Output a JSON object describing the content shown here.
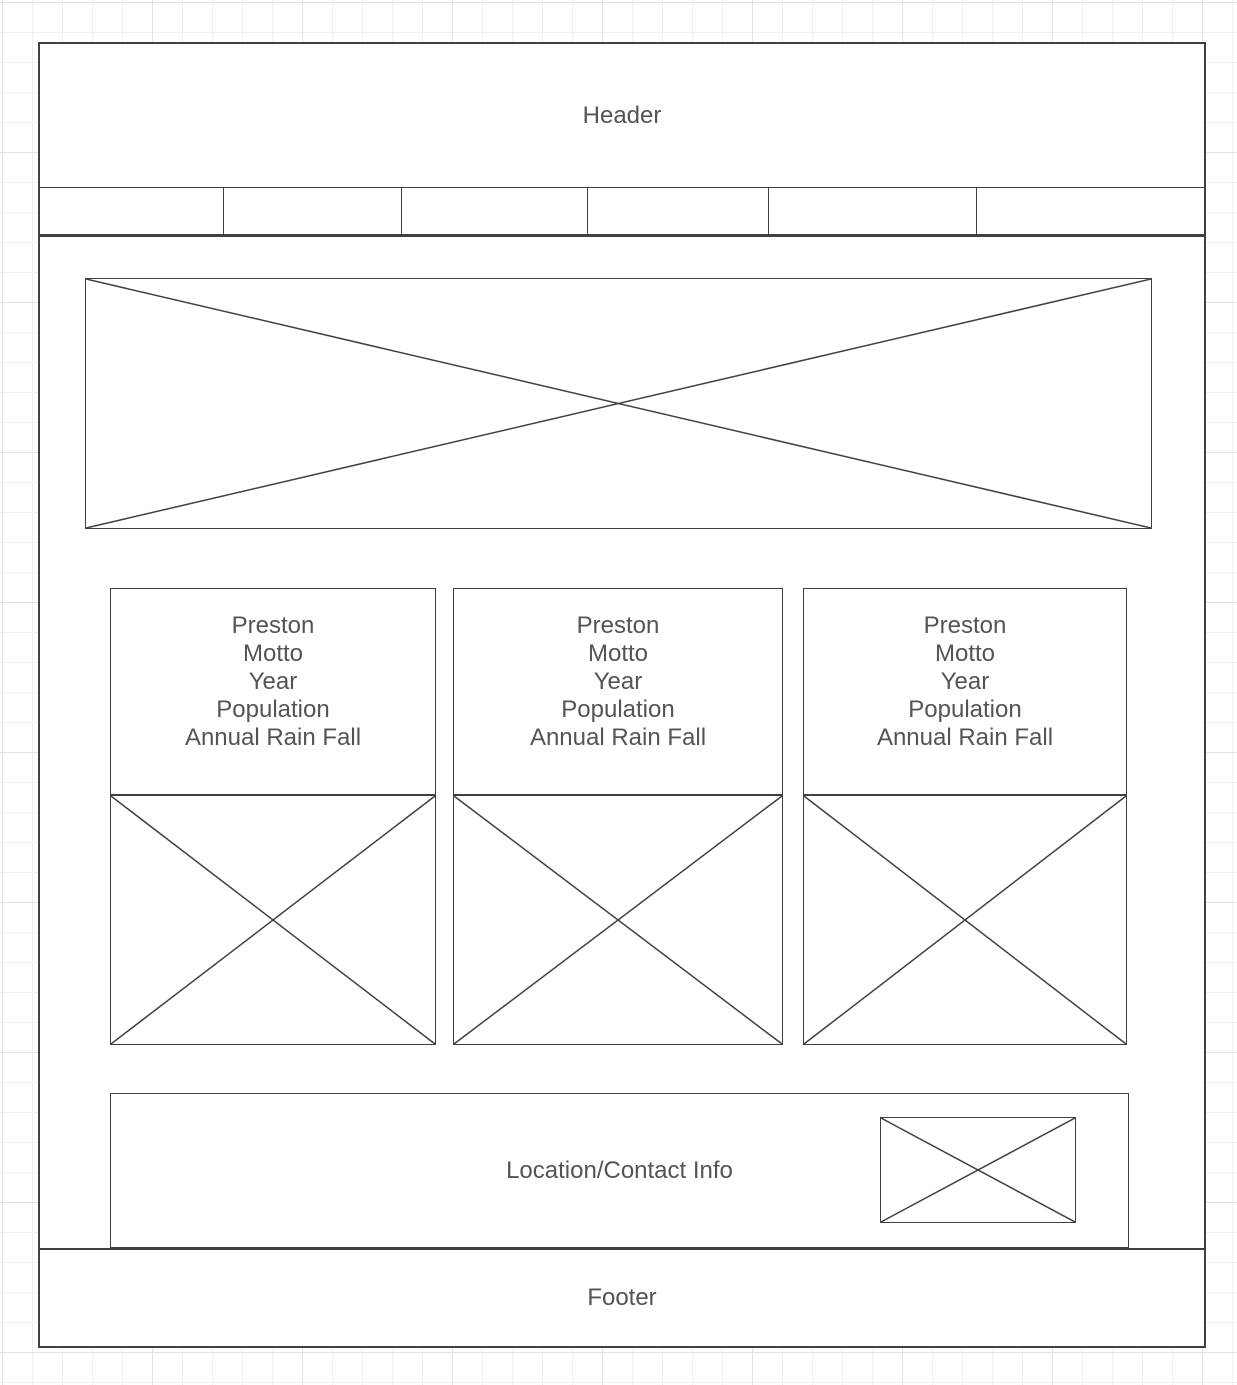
{
  "header": {
    "label": "Header"
  },
  "nav": {
    "cells": [
      "",
      "",
      "",
      "",
      "",
      ""
    ]
  },
  "cards": [
    {
      "lines": [
        "Preston",
        "Motto",
        "Year",
        "Population",
        "Annual Rain Fall"
      ]
    },
    {
      "lines": [
        "Preston",
        "Motto",
        "Year",
        "Population",
        "Annual Rain Fall"
      ]
    },
    {
      "lines": [
        "Preston",
        "Motto",
        "Year",
        "Population",
        "Annual Rain Fall"
      ]
    }
  ],
  "location": {
    "label": "Location/Contact Info"
  },
  "footer": {
    "label": "Footer"
  },
  "colors": {
    "stroke": "#404040",
    "text": "#545454"
  }
}
